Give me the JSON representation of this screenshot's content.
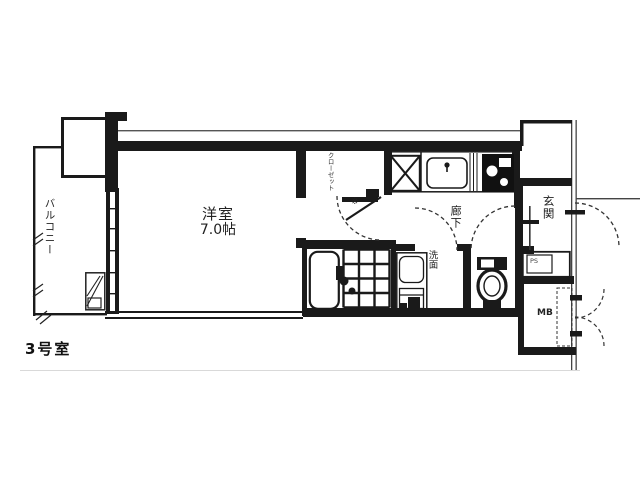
{
  "floor_plan": {
    "unit_label": "3号室",
    "rooms": {
      "balcony": "バルコニー",
      "western_room_name": "洋室",
      "western_room_size": "7.0帖",
      "closet": "クローゼット",
      "hallway": "廊下",
      "entrance": "玄関",
      "washroom": "洗面",
      "pipe_space": "PS",
      "meter_box": "MB",
      "tap_symbol": "※"
    },
    "colors": {
      "wall_line": "#1a1a1a",
      "thin_line": "#555555",
      "faint_line": "#d9d9d9",
      "background": "#ffffff"
    }
  }
}
